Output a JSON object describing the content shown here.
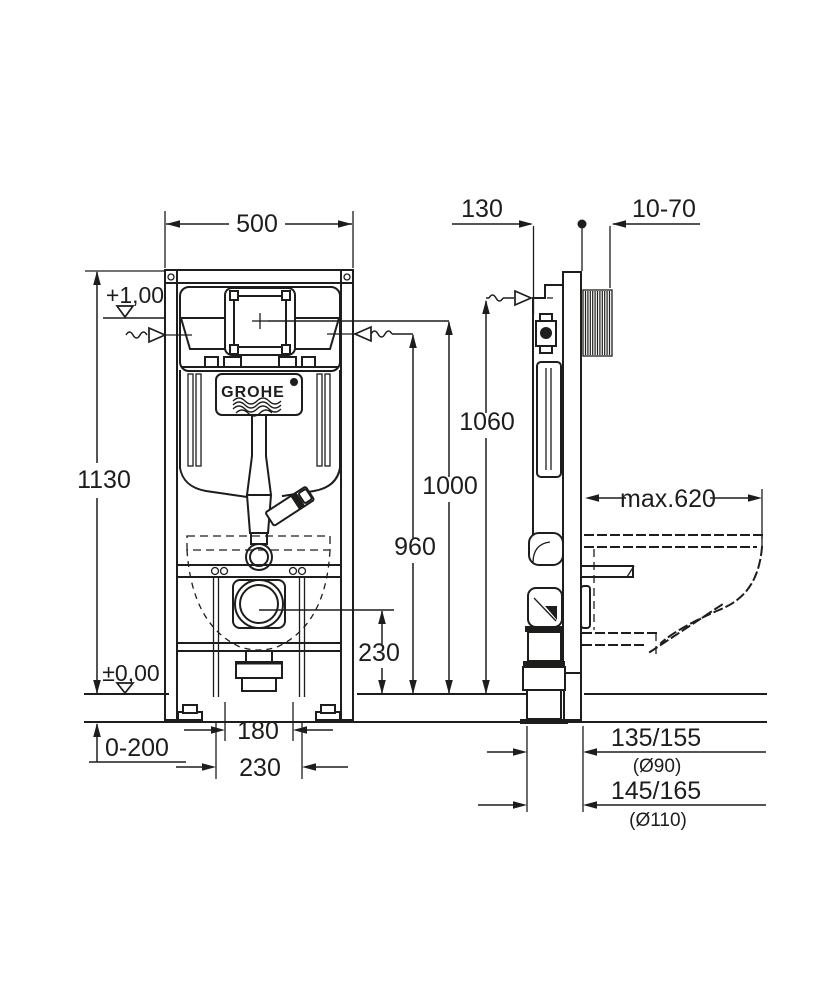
{
  "colors": {
    "line": "#1d1d1b",
    "background": "#ffffff"
  },
  "logo": {
    "brand": "GROHE"
  },
  "front_view": {
    "frame_width": "500",
    "frame_height": "1130",
    "level_supply": "+1,00",
    "level_floor": "±0,00",
    "height_frame_fixing": "1060",
    "height_plate_center": "1000",
    "height_supply": "960",
    "height_drain": "230",
    "bolt_spacing_narrow": "180",
    "bolt_spacing_wide": "230",
    "foot_adjustment": "0-200"
  },
  "side_view": {
    "frame_depth": "130",
    "wall_bracket_range": "10-70",
    "bowl_depth_max": "max.620",
    "drain_offset_90": "135/155",
    "drain_dia_90": "(Ø90)",
    "drain_offset_110": "145/165",
    "drain_dia_110": "(Ø110)"
  }
}
